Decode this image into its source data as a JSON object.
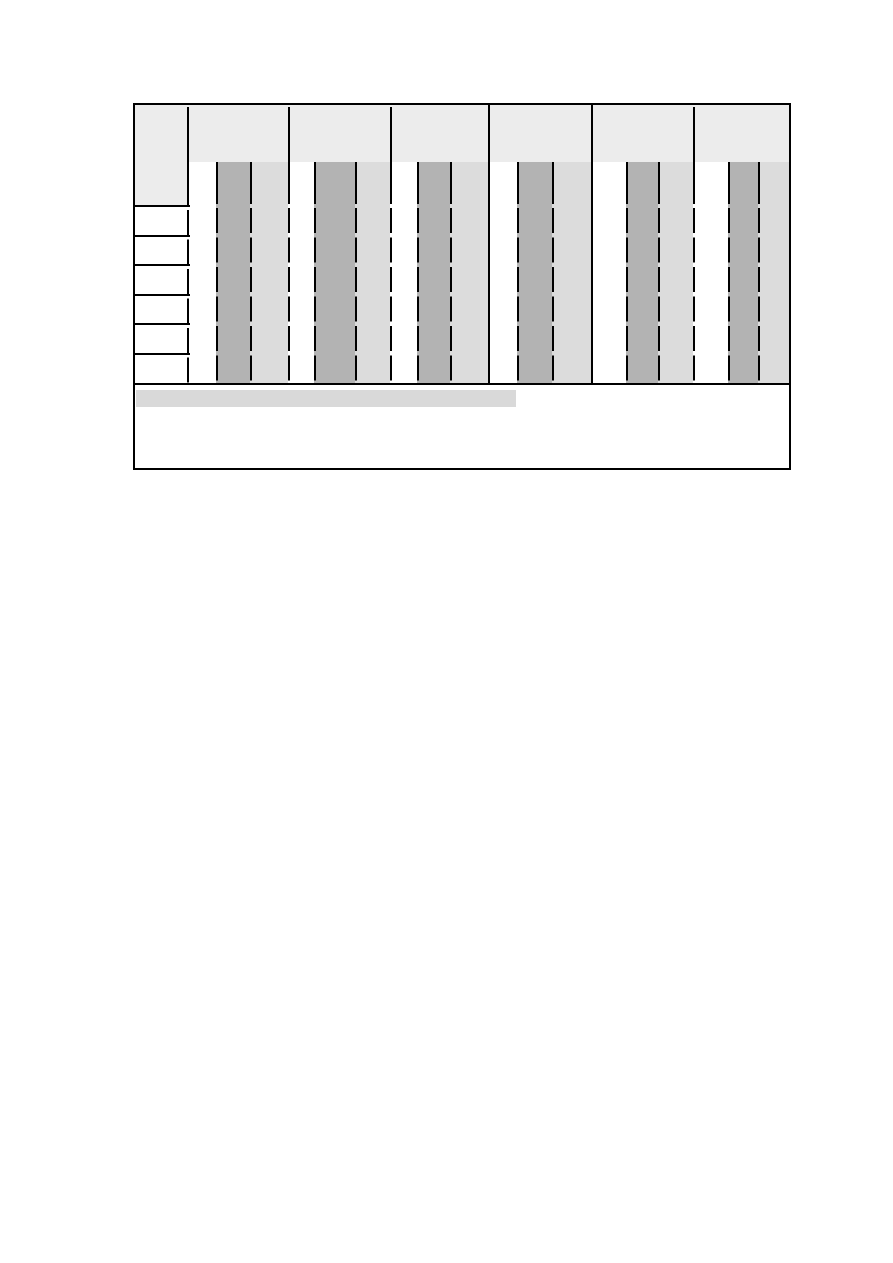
{
  "page": {
    "width": 893,
    "height": 1263,
    "background": "#ffffff"
  },
  "figure": {
    "left": 133,
    "top": 103,
    "width": 658,
    "height": 367,
    "colors": {
      "border": "#000000",
      "header_fill": "#ececec",
      "dark_column": "#b3b3b3",
      "light_column": "#dcdcdc",
      "row_fill": "#ffffff",
      "caption_highlight": "#d9d9d9"
    },
    "header": {
      "band_height": 59,
      "stub_width": 54,
      "stub_height": 103,
      "divider_top": 4,
      "divider_xs": [
        155,
        257,
        560
      ]
    },
    "body": {
      "top": 59,
      "bar_bottom": 281,
      "column_groups": [
        {
          "dark_x": 83,
          "dark_w": 34,
          "light_x": 117,
          "light_w": 38
        },
        {
          "dark_x": 181,
          "dark_w": 41,
          "light_x": 222,
          "light_w": 35
        },
        {
          "dark_x": 284,
          "dark_w": 33,
          "light_x": 317,
          "light_w": 38
        },
        {
          "dark_x": 384,
          "dark_w": 35,
          "light_x": 419,
          "light_w": 39
        },
        {
          "dark_x": 493,
          "dark_w": 32,
          "light_x": 525,
          "light_w": 35
        },
        {
          "dark_x": 595,
          "dark_w": 30,
          "light_x": 625,
          "light_w": 33
        }
      ],
      "dashed_line_xs": [
        83,
        117,
        155,
        181,
        222,
        257,
        284,
        317,
        384,
        419,
        493,
        525,
        560,
        595,
        625
      ],
      "solid_divider_xs": [
        355,
        458
      ],
      "stub_divider_x": 54
    },
    "rows": {
      "count": 6,
      "start_y": 103,
      "height": 29.5,
      "line_overhang": 57
    },
    "separator_y": 280,
    "footer": {
      "top": 282,
      "caption_bar": {
        "x": 3,
        "y": 287,
        "width": 380,
        "height": 17
      }
    }
  }
}
